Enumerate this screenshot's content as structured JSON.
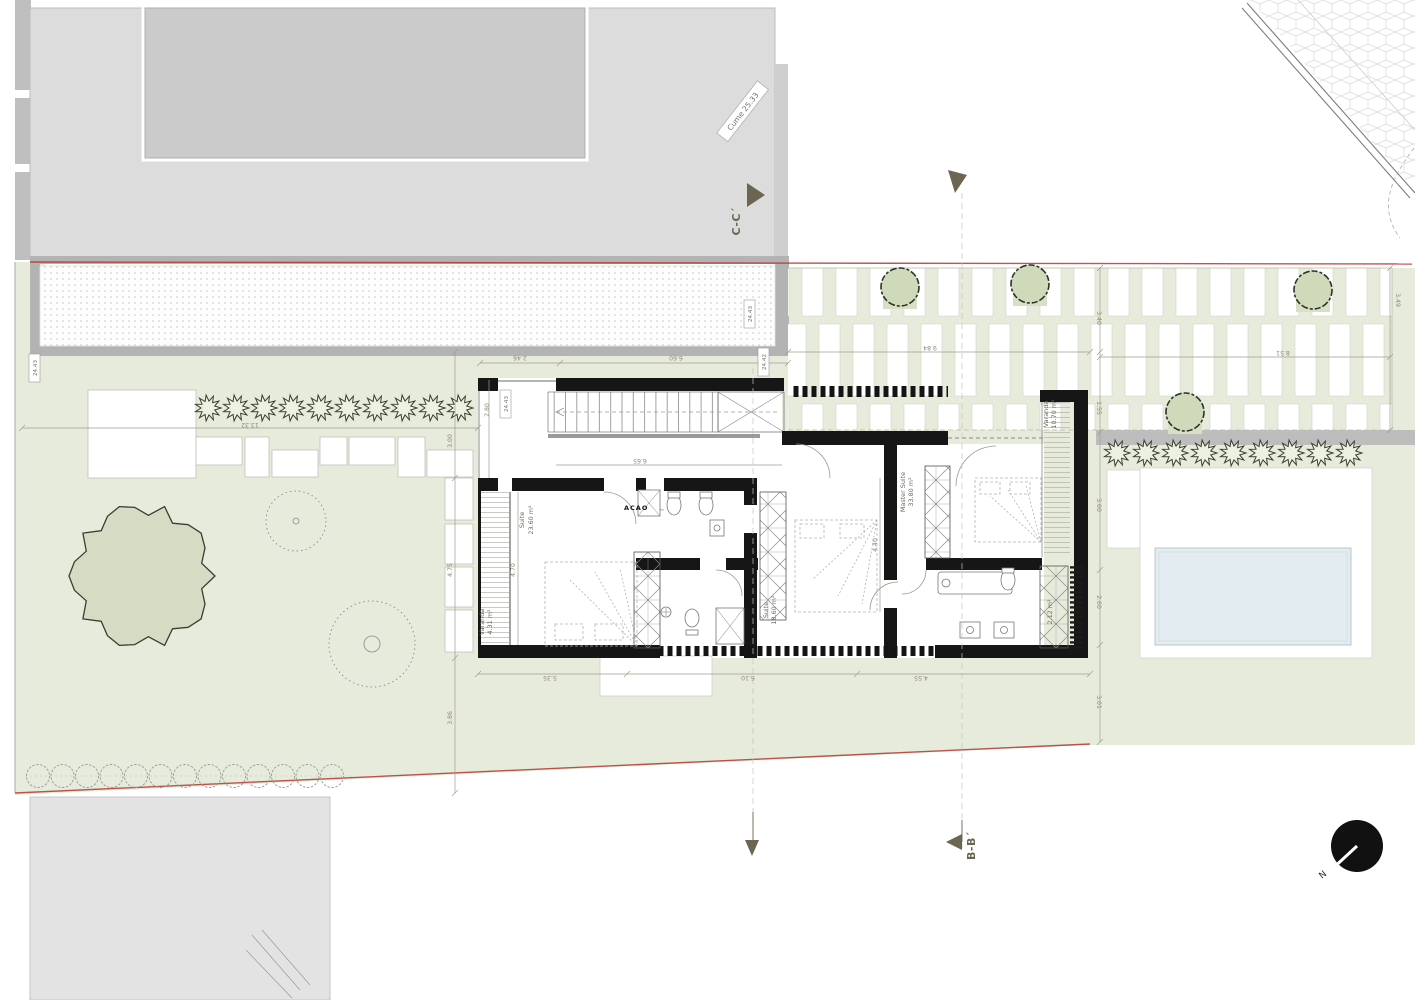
{
  "plan": {
    "rooms": {
      "suite1": {
        "name": "Suite",
        "area": "23.60 m²"
      },
      "suite2": {
        "name": "Suite",
        "area": "18.60 m²"
      },
      "master": {
        "name": "Master Suite",
        "area": "33.80 m²"
      },
      "varanda1": {
        "name": "Varanda",
        "area": "4.31 m²"
      },
      "varanda2": {
        "name": "Varanda",
        "area": "10.70 m²"
      },
      "shaft": {
        "area": "2.12 m²"
      }
    },
    "levels": [
      "24.43",
      "24.43",
      "24.43",
      "24.42"
    ],
    "roof": {
      "label": "Cume 25.33"
    },
    "stamp": {
      "text": "ACAO"
    }
  },
  "sections": {
    "c": "C-C´",
    "b": "B-B´",
    "north": "N"
  },
  "dims": {
    "top": [
      "2.46",
      "6.60",
      "9.84",
      "8.51",
      "3.49"
    ],
    "bottom": [
      "5.35",
      "6.10",
      "4.55"
    ],
    "left": [
      "13.32",
      "3.00",
      "4.75",
      "3.86"
    ],
    "right": [
      "3.40",
      "1.55",
      "3.60",
      "2.60",
      "3.01"
    ],
    "interior": [
      "2.80",
      "6.65",
      "4.70",
      "4.40"
    ]
  },
  "colors": {
    "garden_green": "#e7ebdc",
    "tree_fill": "#d6dcc3",
    "building_gray": "#dcdcdc",
    "wall_black": "#161616",
    "boundary_red": "#b5382e",
    "pool_blue": "#e3ecf0",
    "dim_olive": "#8f8b78"
  }
}
